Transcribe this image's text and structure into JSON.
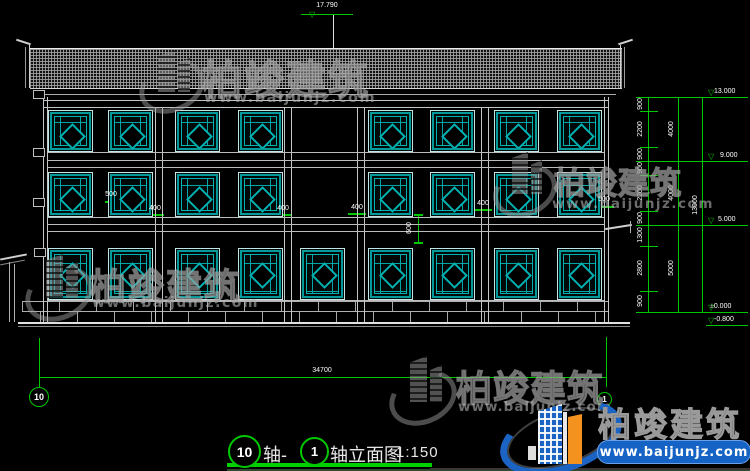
{
  "watermark": {
    "brand": "柏竣建筑",
    "url": "www.baijunjz.com"
  },
  "logo": {
    "brand": "柏竣建筑",
    "url": "www.baijunjz.com"
  },
  "top_level": "17.790",
  "bottom_overall_dim": "34700",
  "axis_bubbles": {
    "left": "10",
    "right": "1"
  },
  "title": {
    "axis_left": "10",
    "joiner": "轴-",
    "axis_right": "1",
    "name": "轴立面图",
    "scale": "1:150"
  },
  "facade_dims": {
    "left_500": "500",
    "right_500": "500",
    "pilaster_400s": [
      "400",
      "400",
      "400",
      "400"
    ],
    "band_600": "600"
  },
  "right_dims": {
    "segments": [
      "900",
      "2200",
      "900",
      "900",
      "2200",
      "900",
      "1300",
      "2800",
      "900"
    ],
    "totals": [
      "4000",
      "4000",
      "5000"
    ],
    "overall": "13000",
    "levels": [
      "13.000",
      "9.000",
      "5.000",
      "±0.000",
      "-0.800"
    ]
  },
  "colors": {
    "dim_green": "#00c800",
    "window_teal": "#00a6a6",
    "logo_blue": "#1b64c4",
    "logo_orange": "#f3921e"
  }
}
